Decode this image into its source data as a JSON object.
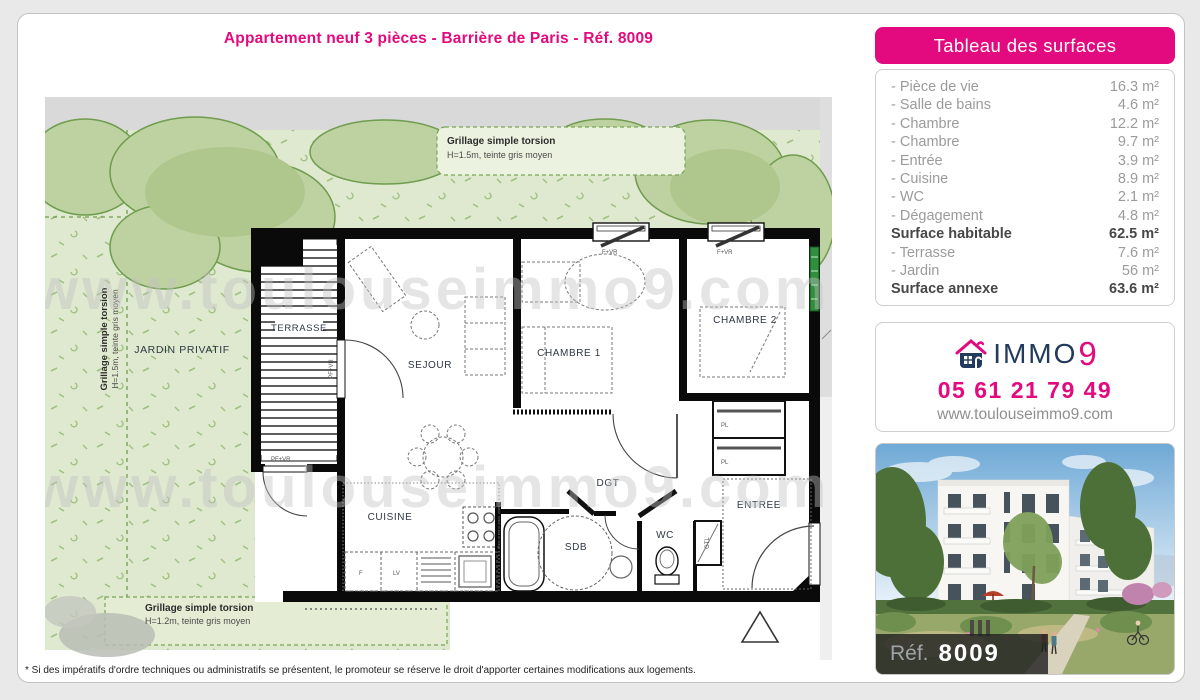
{
  "page": {
    "title": "Appartement neuf 3 pièces - Barrière de Paris - Réf. 8009",
    "footnote": "* Si des impératifs d'ordre techniques ou administratifs se présentent, le promoteur se réserve le droit d'apporter certaines modifications aux logements."
  },
  "surfaces": {
    "header": "Tableau des surfaces",
    "rows": [
      {
        "label": "- Pièce de vie",
        "value": "16.3 m²",
        "bold": false
      },
      {
        "label": "- Salle de bains",
        "value": "4.6 m²",
        "bold": false
      },
      {
        "label": "- Chambre",
        "value": "12.2 m²",
        "bold": false
      },
      {
        "label": "- Chambre",
        "value": "9.7 m²",
        "bold": false
      },
      {
        "label": "- Entrée",
        "value": "3.9 m²",
        "bold": false
      },
      {
        "label": "- Cuisine",
        "value": "8.9 m²",
        "bold": false
      },
      {
        "label": "- WC",
        "value": "2.1 m²",
        "bold": false
      },
      {
        "label": "- Dégagement",
        "value": "4.8 m²",
        "bold": false
      },
      {
        "label": "Surface habitable",
        "value": "62.5 m²",
        "bold": true
      },
      {
        "label": "- Terrasse",
        "value": "7.6 m²",
        "bold": false
      },
      {
        "label": "- Jardin",
        "value": "56 m²",
        "bold": false
      },
      {
        "label": "Surface annexe",
        "value": "63.6 m²",
        "bold": true
      }
    ]
  },
  "contact": {
    "brand_text": "IMMO",
    "brand_digit": "9",
    "phone": "05 61 21 79 49",
    "website": "www.toulouseimmo9.com"
  },
  "photo": {
    "ref_prefix": "Réf.",
    "ref_number": "8009"
  },
  "plan": {
    "watermark": "www.toulouseimmo9.com",
    "labels": {
      "jardin": "JARDIN PRIVATIF",
      "terrasse": "TERRASSE",
      "sejour": "SEJOUR",
      "chambre1": "CHAMBRE 1",
      "chambre2": "CHAMBRE 2",
      "cuisine": "CUISINE",
      "sdb": "SDB",
      "wc": "WC",
      "dgt": "DGT",
      "entree": "ENTREE",
      "gtl": "GTL",
      "pl": "PL",
      "fridge": "F",
      "dishwasher": "LV",
      "window": "F+VR",
      "door_window": "PF+VR"
    },
    "fence_top": {
      "line1": "Grillage simple torsion",
      "line2": "H=1.5m, teinte gris moyen"
    },
    "fence_left": {
      "line1": "Grillage simple torsion",
      "line2": "H=1.5m, teinte gris moyen"
    },
    "fence_bottom": {
      "line1": "Grillage simple torsion",
      "line2": "H=1.2m, teinte gris moyen"
    }
  },
  "colors": {
    "accent_pink": "#e3097e",
    "brand_navy": "#223a5e",
    "garden_green": "#dfe9cf",
    "canopy_green": "#bed1a0"
  }
}
